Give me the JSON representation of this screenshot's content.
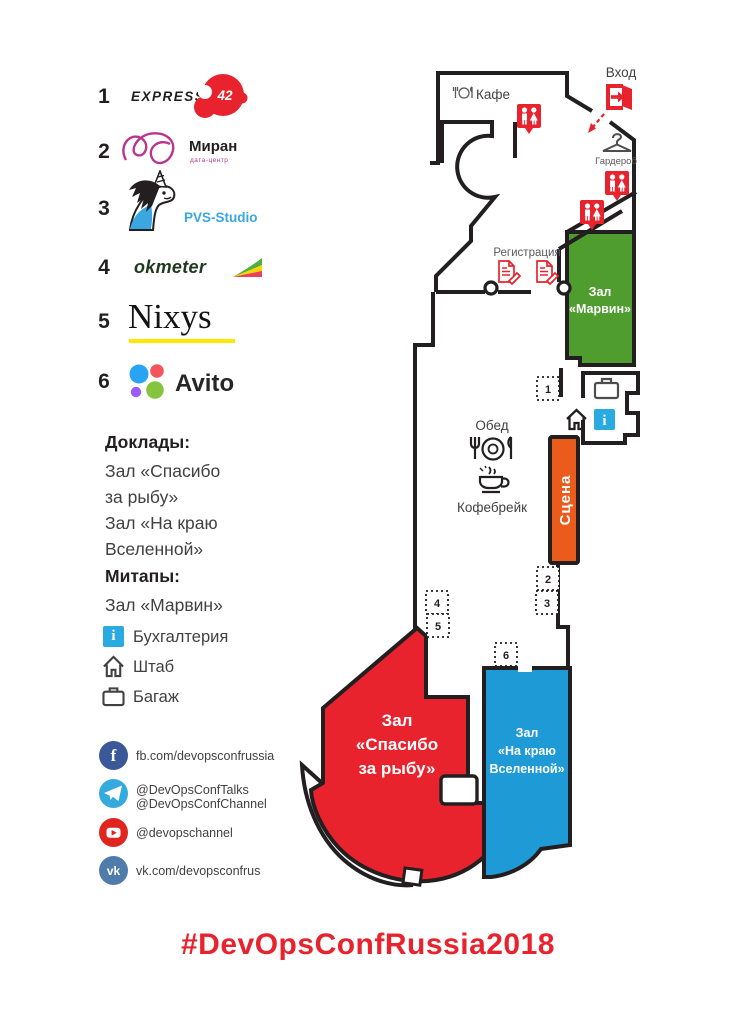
{
  "page": {
    "hashtag": "#DevOpsConfRussia2018"
  },
  "colors": {
    "accent_red": "#e8232d",
    "wall": "#231f20",
    "stage": "#ea5b1c",
    "info_blue": "#29abe2",
    "pvs_blue": "#3aa7e0",
    "miran_magenta": "#b9368e",
    "nixys_underline": "#ffe800",
    "facebook": "#3b5998",
    "telegram": "#34aadf",
    "youtube": "#e0251f",
    "vk": "#4f7cab"
  },
  "sponsors": [
    {
      "num": "1",
      "name": "EXPRESS 42",
      "wordmark": "EXPRESS",
      "badge": "42"
    },
    {
      "num": "2",
      "name": "Миран",
      "wordmark": "Миран",
      "sub": "дата-центр"
    },
    {
      "num": "3",
      "name": "PVS-Studio",
      "wordmark": "PVS-Studio"
    },
    {
      "num": "4",
      "name": "okmeter",
      "wordmark": "okmeter"
    },
    {
      "num": "5",
      "name": "Nixys",
      "wordmark": "Nixys"
    },
    {
      "num": "6",
      "name": "Avito",
      "wordmark": "Avito"
    }
  ],
  "info": {
    "talks_title": "Доклады:",
    "talks_lines": [
      "Зал «Спасибо",
      "за рыбу»",
      "Зал «На краю",
      "Вселенной»"
    ],
    "meetups_title": "Митапы:",
    "meetups_line": "Зал «Марвин»",
    "legend": [
      {
        "icon": "info-icon",
        "label": "Бухгалтерия"
      },
      {
        "icon": "home-icon",
        "label": "Штаб"
      },
      {
        "icon": "briefcase-icon",
        "label": "Багаж"
      }
    ]
  },
  "social": [
    {
      "network": "facebook",
      "line1": "fb.com/devopsconfrussia"
    },
    {
      "network": "telegram",
      "line1": "@DevOpsConfTalks",
      "line2": "@DevOpsConfChannel"
    },
    {
      "network": "youtube",
      "line1": "@devopschannel"
    },
    {
      "network": "vk",
      "line1": "vk.com/devopsconfrus"
    }
  ],
  "map": {
    "labels": {
      "cafe": "Кафе",
      "entrance": "Вход",
      "wardrobe": "Гардероб",
      "registration": "Регистрация",
      "lunch": "Обед",
      "coffee": "Кофебрейк",
      "stage": "Сцена"
    },
    "rooms": {
      "marvin": {
        "color": "#4f9d2f",
        "lines": [
          "Зал",
          "«Марвин»"
        ]
      },
      "fish": {
        "color": "#e8232d",
        "lines": [
          "Зал",
          "«Спасибо",
          "за рыбу»"
        ]
      },
      "universe": {
        "color": "#1e9ad6",
        "lines": [
          "Зал",
          "«На краю",
          "Вселенной»"
        ]
      }
    },
    "markers": [
      "1",
      "2",
      "3",
      "4",
      "5",
      "6"
    ]
  }
}
